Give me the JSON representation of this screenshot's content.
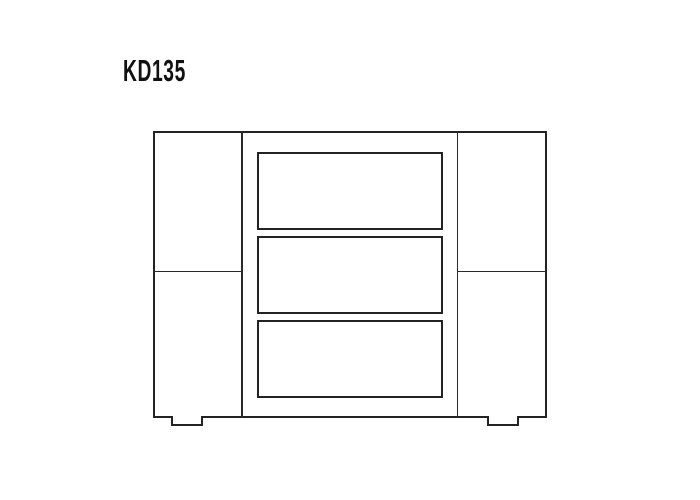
{
  "page": {
    "background": "#ffffff"
  },
  "title": {
    "label": "KD135"
  },
  "diagram": {
    "type": "furniture-line-drawing",
    "product_code": "KD135",
    "line_color": "#232323",
    "fill_color": "#ffffff",
    "structure": {
      "left_section": "door panel with horizontal center seam",
      "center_section": "three stacked drawer fronts",
      "right_section": "door panel with horizontal center seam",
      "drawer_count": 3,
      "feet_count": 2
    }
  }
}
